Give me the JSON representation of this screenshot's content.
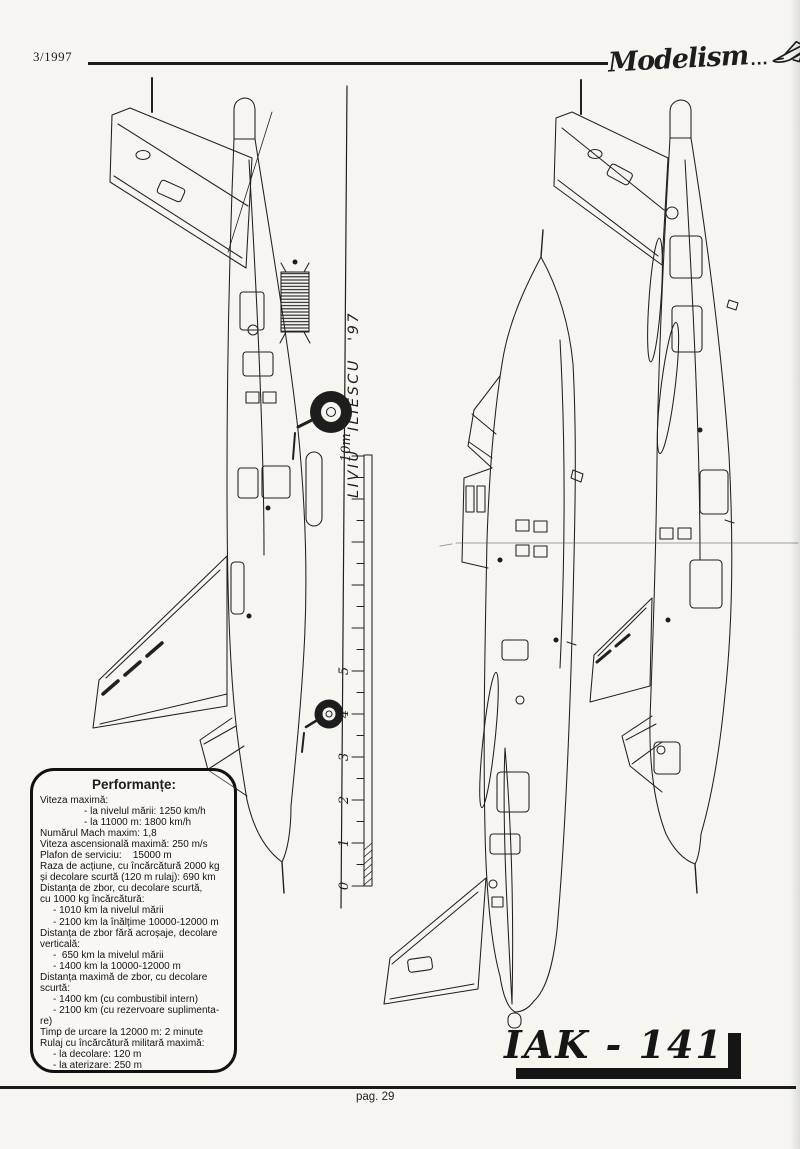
{
  "page": {
    "paper_color": "#f6f5f0",
    "ink_color": "#1d1d1d"
  },
  "header": {
    "issue": "3/1997",
    "magazine_logo": "Modelism",
    "logo_dots": "...",
    "logo_plane_icon": "jet-sketch-icon"
  },
  "signature": {
    "artist": "LIVIU   ILIESCU   '97"
  },
  "ruler": {
    "top_label": "10m",
    "labels": [
      "0",
      "1",
      "2",
      "3",
      "4",
      "5"
    ]
  },
  "figures": {
    "left": "side-view-landing-gear-extended",
    "middle": "side-view-clean",
    "right": "side-view-opposite"
  },
  "spec_box": {
    "title": "Performanțe:",
    "lines": [
      {
        "t": "Viteza maximă:",
        "i": 0
      },
      {
        "t": "- la nivelul mării: 1250 km/h",
        "i": 2
      },
      {
        "t": "- la 11000 m: 1800 km/h",
        "i": 2
      },
      {
        "t": "Numărul Mach maxim: 1,8",
        "i": 0
      },
      {
        "t": "Viteza ascensională maximă: 250 m/s",
        "i": 0
      },
      {
        "t": "Plafon de serviciu:    15000 m",
        "i": 0
      },
      {
        "t": "Raza de acțiune, cu încărcătură 2000 kg",
        "i": 0
      },
      {
        "t": "și decolare scurtă (120 m rulaj): 690 km",
        "i": 0
      },
      {
        "t": "Distanța de zbor, cu decolare scurtă,",
        "i": 0
      },
      {
        "t": "cu 1000 kg încărcătură:",
        "i": 0
      },
      {
        "t": "- 1010 km la nivelul mării",
        "i": 1
      },
      {
        "t": "- 2100 km la înălțime 10000-12000 m",
        "i": 1
      },
      {
        "t": "Distanța de zbor fără acroșaje, decolare",
        "i": 0
      },
      {
        "t": "verticală:",
        "i": 0
      },
      {
        "t": "-  650 km la mivelul mării",
        "i": 1
      },
      {
        "t": "- 1400 km la 10000-12000 m",
        "i": 1
      },
      {
        "t": "Distanța maximă de zbor, cu decolare",
        "i": 0
      },
      {
        "t": "scurtă:",
        "i": 0
      },
      {
        "t": "- 1400 km (cu combustibil intern)",
        "i": 1
      },
      {
        "t": "- 2100 km (cu rezervoare suplimenta-",
        "i": 1
      },
      {
        "t": "re)",
        "i": 0
      },
      {
        "t": "Timp de urcare la 12000 m: 2 minute",
        "i": 0
      },
      {
        "t": "Rulaj cu încărcătură militară maximă:",
        "i": 0
      },
      {
        "t": "- la decolare: 120 m",
        "i": 1
      },
      {
        "t": "- la aterizare: 250 m",
        "i": 1
      }
    ]
  },
  "title_block": {
    "model": "IAK - 141"
  },
  "footer": {
    "page": "pag. 29"
  }
}
